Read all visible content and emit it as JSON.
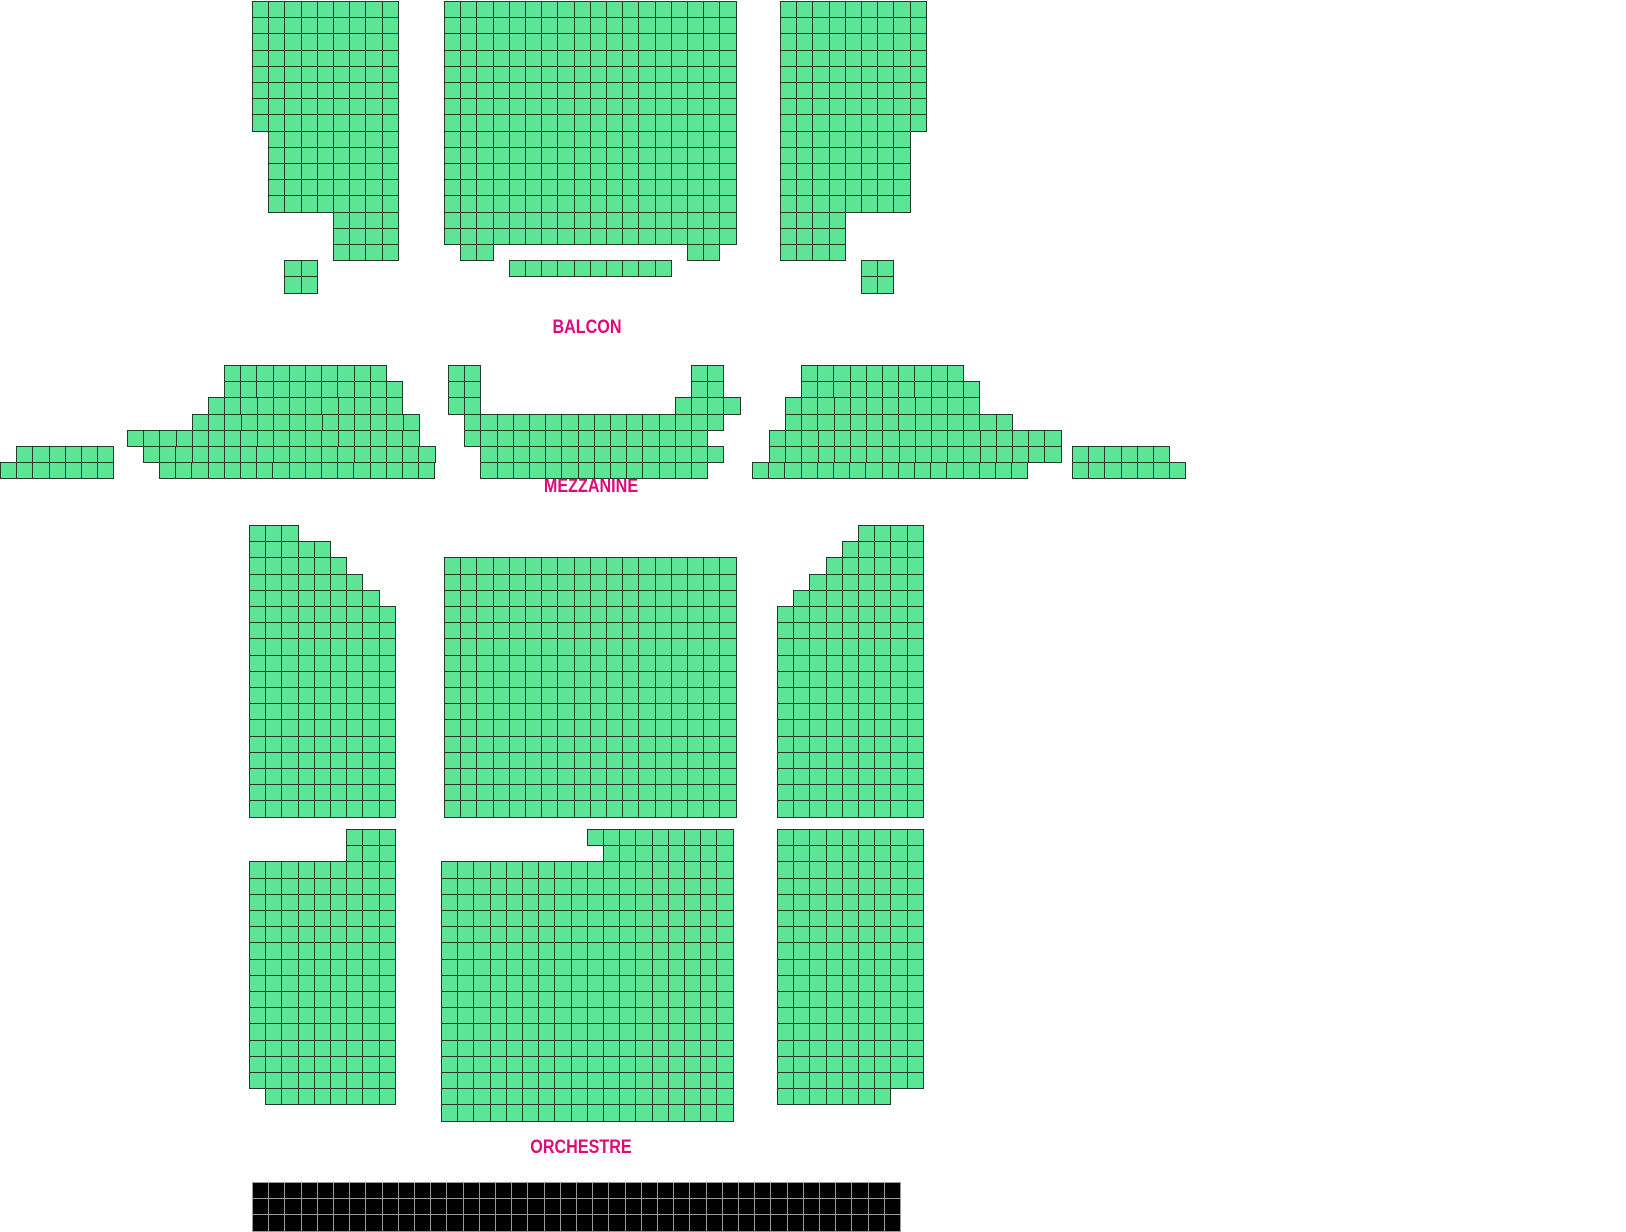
{
  "page": {
    "width": 1626,
    "height": 1220,
    "background": "#ffffff"
  },
  "colors": {
    "seat_available_fill": "#5de596",
    "seat_border": "#223b2b",
    "section_label": "#e00a78",
    "stage_fill": "#000000",
    "stage_gridline": "#9a9a9a"
  },
  "cell": 16.2,
  "sections": [
    {
      "id": "balcon",
      "label": "BALCON",
      "label_x": 587,
      "label_y": 328,
      "blocks": [
        {
          "name": "balcon-left",
          "rows": [
            [
              252,
              1,
              9
            ],
            [
              252,
              17.2,
              9
            ],
            [
              252,
              33.4,
              9
            ],
            [
              252,
              49.6,
              9
            ],
            [
              252,
              65.8,
              9
            ],
            [
              252,
              82,
              9
            ],
            [
              252,
              98.2,
              9
            ],
            [
              252,
              114.4,
              9
            ],
            [
              268.2,
              130.6,
              8
            ],
            [
              268.2,
              146.8,
              8
            ],
            [
              268.2,
              163,
              8
            ],
            [
              268.2,
              179.2,
              8
            ],
            [
              268.2,
              195.4,
              8
            ],
            [
              333,
              211.6,
              4
            ],
            [
              333,
              227.8,
              4
            ],
            [
              333,
              244,
              4
            ],
            [
              284.4,
              260.2,
              2
            ],
            [
              284.4,
              276.4,
              2
            ]
          ]
        },
        {
          "name": "balcon-center",
          "rows": [
            [
              444,
              1,
              18
            ],
            [
              444,
              17.2,
              18
            ],
            [
              444,
              33.4,
              18
            ],
            [
              444,
              49.6,
              18
            ],
            [
              444,
              65.8,
              18
            ],
            [
              444,
              82,
              18
            ],
            [
              444,
              98.2,
              18
            ],
            [
              444,
              114.4,
              18
            ],
            [
              444,
              130.6,
              18
            ],
            [
              444,
              146.8,
              18
            ],
            [
              444,
              163,
              18
            ],
            [
              444,
              179.2,
              18
            ],
            [
              444,
              195.4,
              18
            ],
            [
              444,
              211.6,
              18
            ],
            [
              444,
              227.8,
              18
            ],
            [
              460.2,
              244,
              2
            ],
            [
              687,
              244,
              2
            ],
            [
              508.8,
              260.2,
              10
            ]
          ]
        },
        {
          "name": "balcon-right",
          "rows": [
            [
              780,
              1,
              9
            ],
            [
              780,
              17.2,
              9
            ],
            [
              780,
              33.4,
              9
            ],
            [
              780,
              49.6,
              9
            ],
            [
              780,
              65.8,
              9
            ],
            [
              780,
              82,
              9
            ],
            [
              780,
              98.2,
              9
            ],
            [
              780,
              114.4,
              9
            ],
            [
              780,
              130.6,
              8
            ],
            [
              780,
              146.8,
              8
            ],
            [
              780,
              163,
              8
            ],
            [
              780,
              179.2,
              8
            ],
            [
              780,
              195.4,
              8
            ],
            [
              780,
              211.6,
              4
            ],
            [
              780,
              227.8,
              4
            ],
            [
              780,
              244,
              4
            ],
            [
              861,
              260.2,
              2
            ],
            [
              861,
              276.4,
              2
            ]
          ]
        }
      ]
    },
    {
      "id": "mezzanine",
      "label": "MEZZANINE",
      "label_x": 591,
      "label_y": 487,
      "blocks": [
        {
          "name": "mezzanine-far-left",
          "rows": [
            [
              16.2,
              446,
              6
            ],
            [
              0,
              462.2,
              7
            ]
          ]
        },
        {
          "name": "mezzanine-left-wing",
          "rows": [
            [
              224,
              365,
              10
            ],
            [
              224,
              381.2,
              11
            ],
            [
              208,
              397.4,
              12
            ],
            [
              192,
              413.6,
              14
            ],
            [
              127,
              429.8,
              18
            ],
            [
              143,
              446,
              18
            ],
            [
              159,
              462.2,
              17
            ]
          ]
        },
        {
          "name": "mezzanine-center",
          "rows": [
            [
              448,
              365,
              2
            ],
            [
              691,
              365,
              2
            ],
            [
              448,
              381.2,
              2
            ],
            [
              691,
              381.2,
              2
            ],
            [
              448,
              397.4,
              2
            ],
            [
              674.8,
              397.4,
              4
            ],
            [
              464.2,
              413.6,
              16
            ],
            [
              464.2,
              429.8,
              15
            ],
            [
              480.4,
              446,
              15
            ],
            [
              480.4,
              462.2,
              14
            ]
          ]
        },
        {
          "name": "mezzanine-right-wing",
          "rows": [
            [
              801,
              365,
              10
            ],
            [
              801,
              381.2,
              11
            ],
            [
              785,
              397.4,
              12
            ],
            [
              785,
              413.6,
              14
            ],
            [
              769,
              429.8,
              18
            ],
            [
              769,
              446,
              18
            ],
            [
              752,
              462.2,
              17
            ]
          ]
        },
        {
          "name": "mezzanine-far-right",
          "rows": [
            [
              1072,
              446,
              6
            ],
            [
              1072,
              462.2,
              7
            ]
          ]
        }
      ]
    },
    {
      "id": "orchestre",
      "label": "ORCHESTRE",
      "label_x": 581,
      "label_y": 1148,
      "blocks": [
        {
          "name": "orchestre-upper-left",
          "rows": [
            [
              249,
              525,
              3
            ],
            [
              249,
              541.2,
              5
            ],
            [
              249,
              557.4,
              6
            ],
            [
              249,
              573.6,
              7
            ],
            [
              249,
              589.8,
              8
            ],
            [
              249,
              606,
              9
            ],
            [
              249,
              622.2,
              9
            ],
            [
              249,
              638.4,
              9
            ],
            [
              249,
              654.6,
              9
            ],
            [
              249,
              670.8,
              9
            ],
            [
              249,
              687,
              9
            ],
            [
              249,
              703.2,
              9
            ],
            [
              249,
              719.4,
              9
            ],
            [
              249,
              735.6,
              9
            ],
            [
              249,
              751.8,
              9
            ],
            [
              249,
              768,
              9
            ],
            [
              249,
              784.2,
              9
            ],
            [
              249,
              800.4,
              9
            ]
          ]
        },
        {
          "name": "orchestre-upper-center",
          "rows": [
            [
              444,
              557.4,
              18
            ],
            [
              444,
              573.6,
              18
            ],
            [
              444,
              589.8,
              18
            ],
            [
              444,
              606,
              18
            ],
            [
              444,
              622.2,
              18
            ],
            [
              444,
              638.4,
              18
            ],
            [
              444,
              654.6,
              18
            ],
            [
              444,
              670.8,
              18
            ],
            [
              444,
              687,
              18
            ],
            [
              444,
              703.2,
              18
            ],
            [
              444,
              719.4,
              18
            ],
            [
              444,
              735.6,
              18
            ],
            [
              444,
              751.8,
              18
            ],
            [
              444,
              768,
              18
            ],
            [
              444,
              784.2,
              18
            ],
            [
              444,
              800.4,
              18
            ]
          ]
        },
        {
          "name": "orchestre-upper-right",
          "rows": [
            [
              858,
              525,
              4
            ],
            [
              841.8,
              541.2,
              5
            ],
            [
              825.6,
              557.4,
              6
            ],
            [
              809.4,
              573.6,
              7
            ],
            [
              793.2,
              589.8,
              8
            ],
            [
              777,
              606,
              9
            ],
            [
              777,
              622.2,
              9
            ],
            [
              777,
              638.4,
              9
            ],
            [
              777,
              654.6,
              9
            ],
            [
              777,
              670.8,
              9
            ],
            [
              777,
              687,
              9
            ],
            [
              777,
              703.2,
              9
            ],
            [
              777,
              719.4,
              9
            ],
            [
              777,
              735.6,
              9
            ],
            [
              777,
              751.8,
              9
            ],
            [
              777,
              768,
              9
            ],
            [
              777,
              784.2,
              9
            ],
            [
              777,
              800.4,
              9
            ]
          ]
        },
        {
          "name": "orchestre-lower-left",
          "rows": [
            [
              346.2,
              829,
              3
            ],
            [
              346.2,
              845.2,
              3
            ],
            [
              249,
              861.4,
              9
            ],
            [
              249,
              877.6,
              9
            ],
            [
              249,
              893.8,
              9
            ],
            [
              249,
              910,
              9
            ],
            [
              249,
              926.2,
              9
            ],
            [
              249,
              942.4,
              9
            ],
            [
              249,
              958.6,
              9
            ],
            [
              249,
              974.8,
              9
            ],
            [
              249,
              991,
              9
            ],
            [
              249,
              1007.2,
              9
            ],
            [
              249,
              1023.4,
              9
            ],
            [
              249,
              1039.6,
              9
            ],
            [
              249,
              1055.8,
              9
            ],
            [
              249,
              1072,
              9
            ],
            [
              265.2,
              1088.2,
              8
            ]
          ]
        },
        {
          "name": "orchestre-lower-center",
          "rows": [
            [
              586.8,
              829,
              9
            ],
            [
              603,
              845.2,
              8
            ],
            [
              441,
              861.4,
              18
            ],
            [
              441,
              877.6,
              18
            ],
            [
              441,
              893.8,
              18
            ],
            [
              441,
              910,
              18
            ],
            [
              441,
              926.2,
              18
            ],
            [
              441,
              942.4,
              18
            ],
            [
              441,
              958.6,
              18
            ],
            [
              441,
              974.8,
              18
            ],
            [
              441,
              991,
              18
            ],
            [
              441,
              1007.2,
              18
            ],
            [
              441,
              1023.4,
              18
            ],
            [
              441,
              1039.6,
              18
            ],
            [
              441,
              1055.8,
              18
            ],
            [
              441,
              1072,
              18
            ],
            [
              441,
              1088.2,
              18
            ],
            [
              441,
              1104.4,
              18
            ]
          ]
        },
        {
          "name": "orchestre-lower-right",
          "rows": [
            [
              777,
              829,
              9
            ],
            [
              777,
              845.2,
              9
            ],
            [
              777,
              861.4,
              9
            ],
            [
              777,
              877.6,
              9
            ],
            [
              777,
              893.8,
              9
            ],
            [
              777,
              910,
              9
            ],
            [
              777,
              926.2,
              9
            ],
            [
              777,
              942.4,
              9
            ],
            [
              777,
              958.6,
              9
            ],
            [
              777,
              974.8,
              9
            ],
            [
              777,
              991,
              9
            ],
            [
              777,
              1007.2,
              9
            ],
            [
              777,
              1023.4,
              9
            ],
            [
              777,
              1039.6,
              9
            ],
            [
              777,
              1055.8,
              9
            ],
            [
              777,
              1072,
              9
            ],
            [
              777,
              1088.2,
              7
            ]
          ]
        }
      ]
    }
  ],
  "stage": {
    "x": 252,
    "y": 1182,
    "cols": 40,
    "rows": 3
  }
}
